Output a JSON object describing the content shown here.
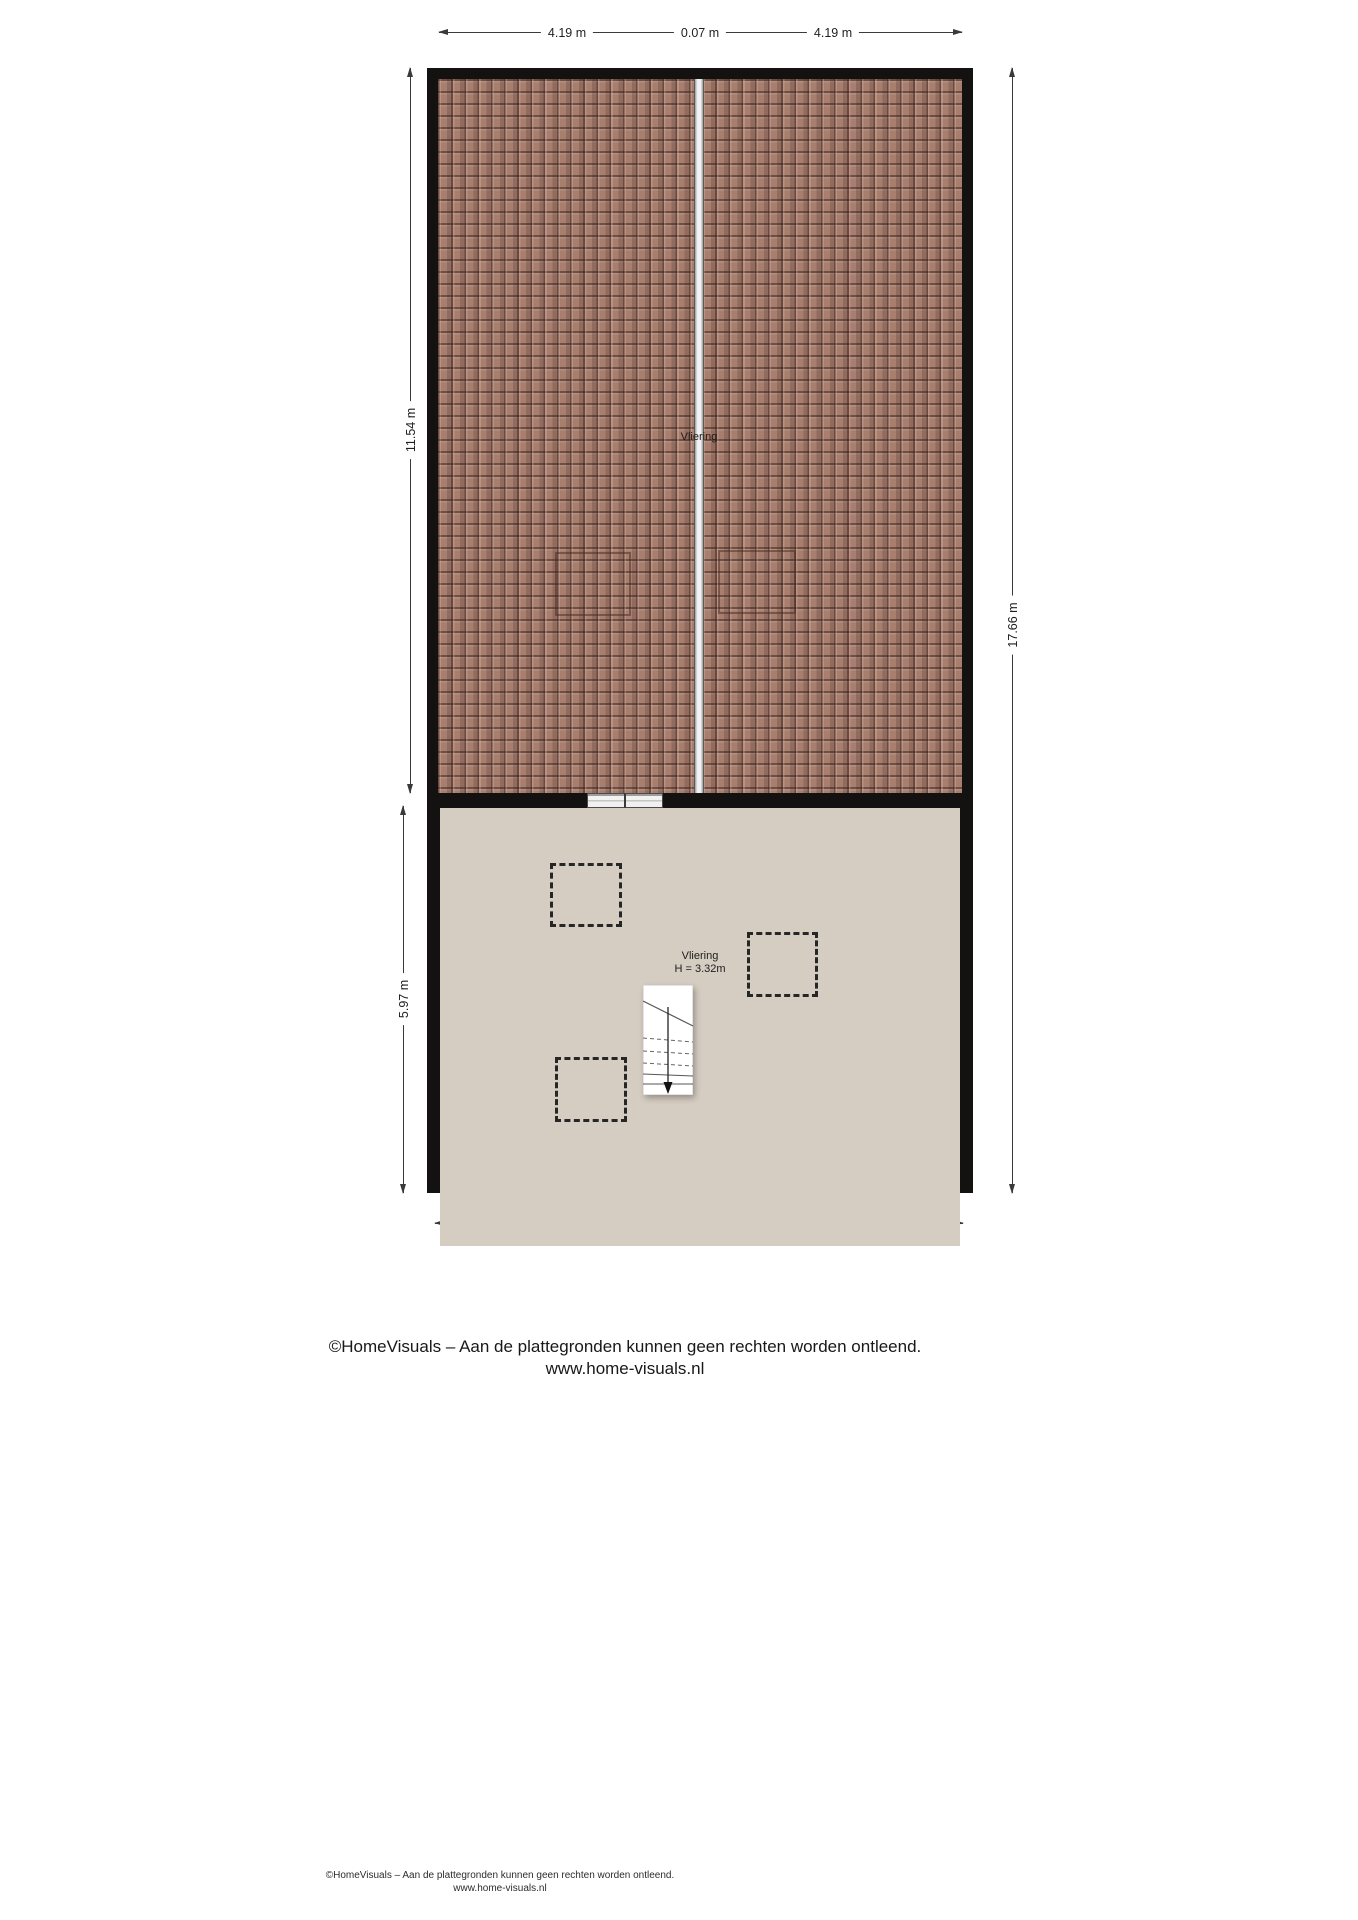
{
  "floorplan": {
    "roof_label": "Vliering",
    "room_label": "Vliering",
    "room_height": "H = 3.32m",
    "colors": {
      "wall": "#141210",
      "roof_tile": "#a87e6f",
      "ridge": "#f3f3f3",
      "floor": "#d6cdc2"
    }
  },
  "dimensions": {
    "top": [
      "4.19 m",
      "0.07 m",
      "4.19 m"
    ],
    "left_upper": "11.54 m",
    "left_lower": "5.97 m",
    "right": "17.66 m",
    "bottom": "8.46 m"
  },
  "footer": {
    "copyright_line1": "©HomeVisuals – Aan de plattegronden kunnen geen rechten worden ontleend.",
    "copyright_line2": "www.home-visuals.nl"
  },
  "footnote": {
    "line1": "©HomeVisuals – Aan de plattegronden kunnen geen rechten worden ontleend.",
    "line2": "www.home-visuals.nl"
  }
}
